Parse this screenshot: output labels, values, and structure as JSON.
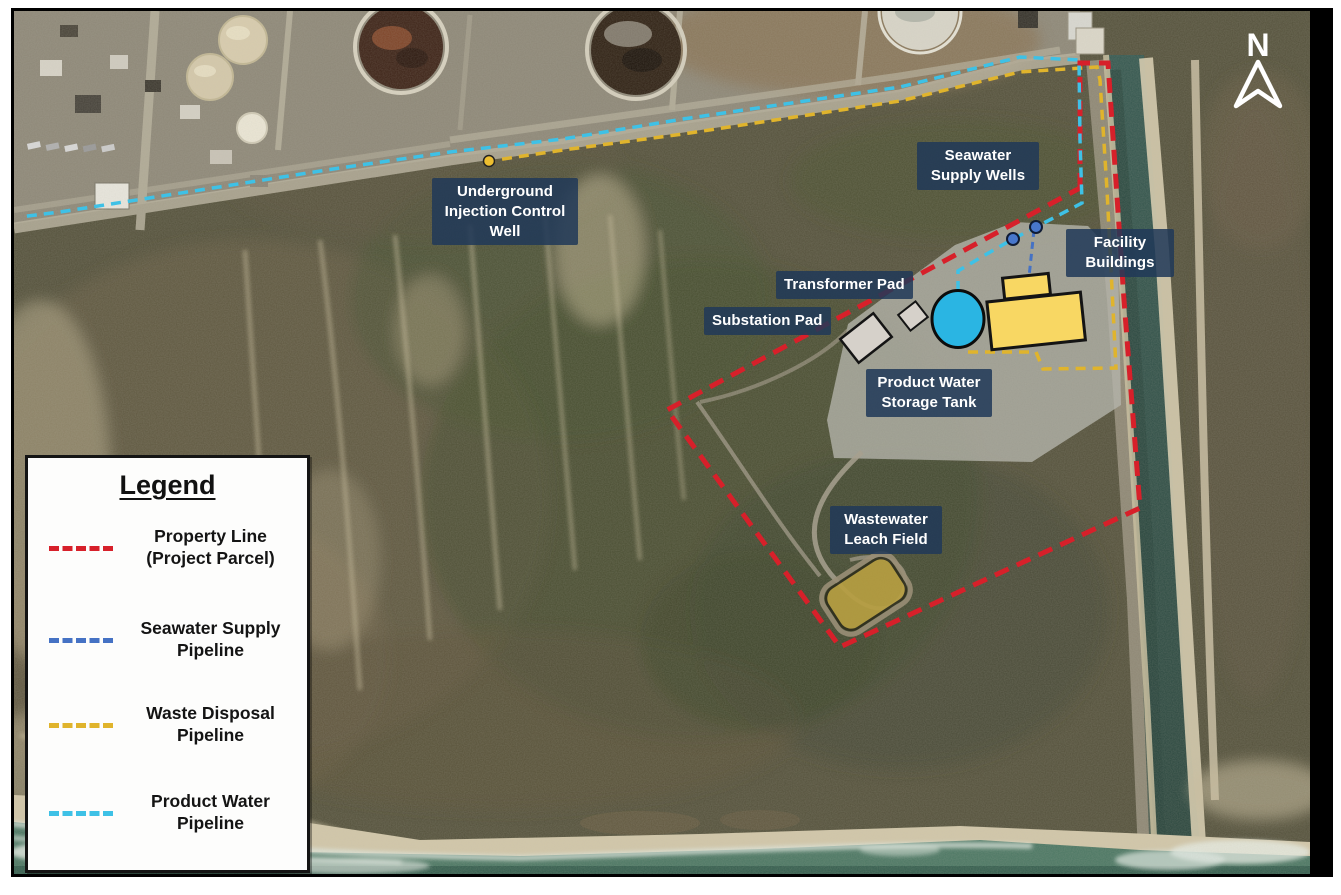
{
  "map": {
    "north_label": "N",
    "feature_labels": [
      {
        "id": "underground-injection-control-well",
        "text": "Underground Injection Control Well"
      },
      {
        "id": "seawater-supply-wells",
        "text": "Seawater Supply Wells"
      },
      {
        "id": "facility-buildings",
        "text": "Facility Buildings"
      },
      {
        "id": "transformer-pad",
        "text": "Transformer Pad"
      },
      {
        "id": "substation-pad",
        "text": "Substation Pad"
      },
      {
        "id": "product-water-storage-tank",
        "text": "Product Water Storage Tank"
      },
      {
        "id": "wastewater-leach-field",
        "text": "Wastewater Leach Field"
      }
    ],
    "colors": {
      "property_line": "#d7202a",
      "seawater_supply_pipeline": "#4572c4",
      "waste_disposal_pipeline": "#e0b42c",
      "product_water_pipeline": "#3ec1e6",
      "facility_building_fill": "#f8d763",
      "storage_tank_fill": "#2ab5e3",
      "well_fill": "#4877cc",
      "pad_fill": "#d6d1ca",
      "leach_field_fill": "#b79f42",
      "injection_well_marker": "#edbe30",
      "label_background": "rgba(33,57,88,0.86)",
      "north_arrow": "#ffffff"
    }
  },
  "legend": {
    "title": "Legend",
    "items": [
      {
        "label": "Property Line (Project Parcel)"
      },
      {
        "label": "Seawater Supply Pipeline"
      },
      {
        "label": "Waste Disposal Pipeline"
      },
      {
        "label": "Product Water Pipeline"
      }
    ]
  }
}
